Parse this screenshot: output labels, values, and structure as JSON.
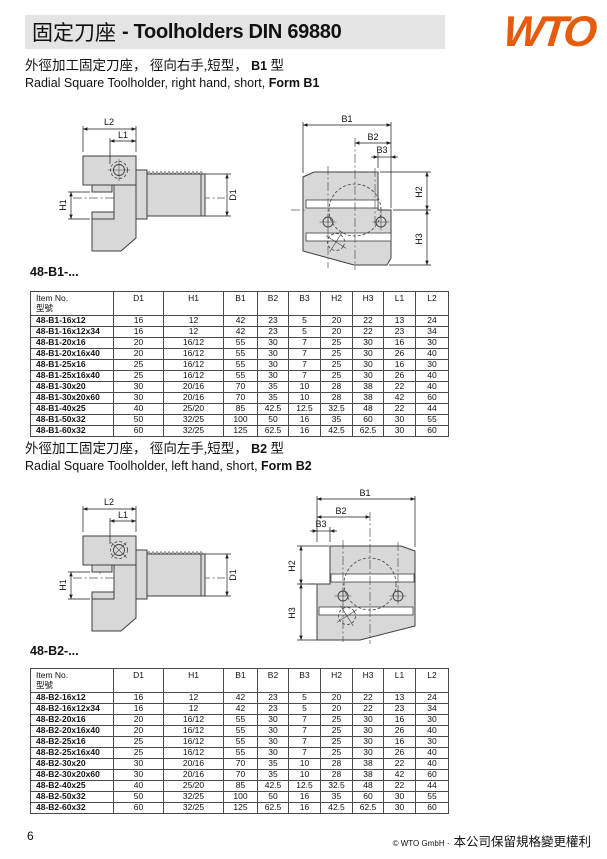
{
  "header": {
    "title_cn": "固定刀座",
    "title_rest": "- Toolholders DIN 69880",
    "logo": "WTO",
    "logo_color": "#E55C0D"
  },
  "dims": {
    "L1": "L1",
    "L2": "L2",
    "H1": "H1",
    "D1": "D1",
    "B1": "B1",
    "B2": "B2",
    "B3": "B3",
    "H2": "H2",
    "H3": "H3"
  },
  "table_header": {
    "item_line1": "Item No.",
    "item_line2": "型號",
    "cols": [
      "D1",
      "H1",
      "B1",
      "B2",
      "B3",
      "H2",
      "H3",
      "L1",
      "L2"
    ]
  },
  "sections": [
    {
      "subtitle_cn": "外徑加工固定刀座， 徑向右手,短型，",
      "subtitle_cn_bold": "B1",
      "subtitle_cn_tail": "型",
      "subtitle_en": "Radial Square Toolholder, right hand, short,",
      "subtitle_en_bold": "Form B1",
      "label": "48-B1-...",
      "rows": [
        [
          "48-B1-16x12",
          "16",
          "12",
          "42",
          "23",
          "5",
          "20",
          "22",
          "13",
          "24"
        ],
        [
          "48-B1-16x12x34",
          "16",
          "12",
          "42",
          "23",
          "5",
          "20",
          "22",
          "23",
          "34"
        ],
        [
          "48-B1-20x16",
          "20",
          "16/12",
          "55",
          "30",
          "7",
          "25",
          "30",
          "16",
          "30"
        ],
        [
          "48-B1-20x16x40",
          "20",
          "16/12",
          "55",
          "30",
          "7",
          "25",
          "30",
          "26",
          "40"
        ],
        [
          "48-B1-25x16",
          "25",
          "16/12",
          "55",
          "30",
          "7",
          "25",
          "30",
          "16",
          "30"
        ],
        [
          "48-B1-25x16x40",
          "25",
          "16/12",
          "55",
          "30",
          "7",
          "25",
          "30",
          "26",
          "40"
        ],
        [
          "48-B1-30x20",
          "30",
          "20/16",
          "70",
          "35",
          "10",
          "28",
          "38",
          "22",
          "40"
        ],
        [
          "48-B1-30x20x60",
          "30",
          "20/16",
          "70",
          "35",
          "10",
          "28",
          "38",
          "42",
          "60"
        ],
        [
          "48-B1-40x25",
          "40",
          "25/20",
          "85",
          "42.5",
          "12.5",
          "32.5",
          "48",
          "22",
          "44"
        ],
        [
          "48-B1-50x32",
          "50",
          "32/25",
          "100",
          "50",
          "16",
          "35",
          "60",
          "30",
          "55"
        ],
        [
          "48-B1-60x32",
          "60",
          "32/25",
          "125",
          "62.5",
          "16",
          "42.5",
          "62.5",
          "30",
          "60"
        ]
      ]
    },
    {
      "subtitle_cn": "外徑加工固定刀座， 徑向左手,短型，",
      "subtitle_cn_bold": "B2",
      "subtitle_cn_tail": "型",
      "subtitle_en": "Radial Square Toolholder, left hand, short,",
      "subtitle_en_bold": "Form B2",
      "label": "48-B2-...",
      "rows": [
        [
          "48-B2-16x12",
          "16",
          "12",
          "42",
          "23",
          "5",
          "20",
          "22",
          "13",
          "24"
        ],
        [
          "48-B2-16x12x34",
          "16",
          "12",
          "42",
          "23",
          "5",
          "20",
          "22",
          "23",
          "34"
        ],
        [
          "48-B2-20x16",
          "20",
          "16/12",
          "55",
          "30",
          "7",
          "25",
          "30",
          "16",
          "30"
        ],
        [
          "48-B2-20x16x40",
          "20",
          "16/12",
          "55",
          "30",
          "7",
          "25",
          "30",
          "26",
          "40"
        ],
        [
          "48-B2-25x16",
          "25",
          "16/12",
          "55",
          "30",
          "7",
          "25",
          "30",
          "16",
          "30"
        ],
        [
          "48-B2-25x16x40",
          "25",
          "16/12",
          "55",
          "30",
          "7",
          "25",
          "30",
          "26",
          "40"
        ],
        [
          "48-B2-30x20",
          "30",
          "20/16",
          "70",
          "35",
          "10",
          "28",
          "38",
          "22",
          "40"
        ],
        [
          "48-B2-30x20x60",
          "30",
          "20/16",
          "70",
          "35",
          "10",
          "28",
          "38",
          "42",
          "60"
        ],
        [
          "48-B2-40x25",
          "40",
          "25/20",
          "85",
          "42.5",
          "12.5",
          "32.5",
          "48",
          "22",
          "44"
        ],
        [
          "48-B2-50x32",
          "50",
          "32/25",
          "100",
          "50",
          "16",
          "35",
          "60",
          "30",
          "55"
        ],
        [
          "48-B2-60x32",
          "60",
          "32/25",
          "125",
          "62.5",
          "16",
          "42.5",
          "62.5",
          "30",
          "60"
        ]
      ]
    }
  ],
  "footer": {
    "page": "6",
    "copyright": "© WTO GmbH ·",
    "rights_cn": "本公司保留規格變更權利"
  }
}
